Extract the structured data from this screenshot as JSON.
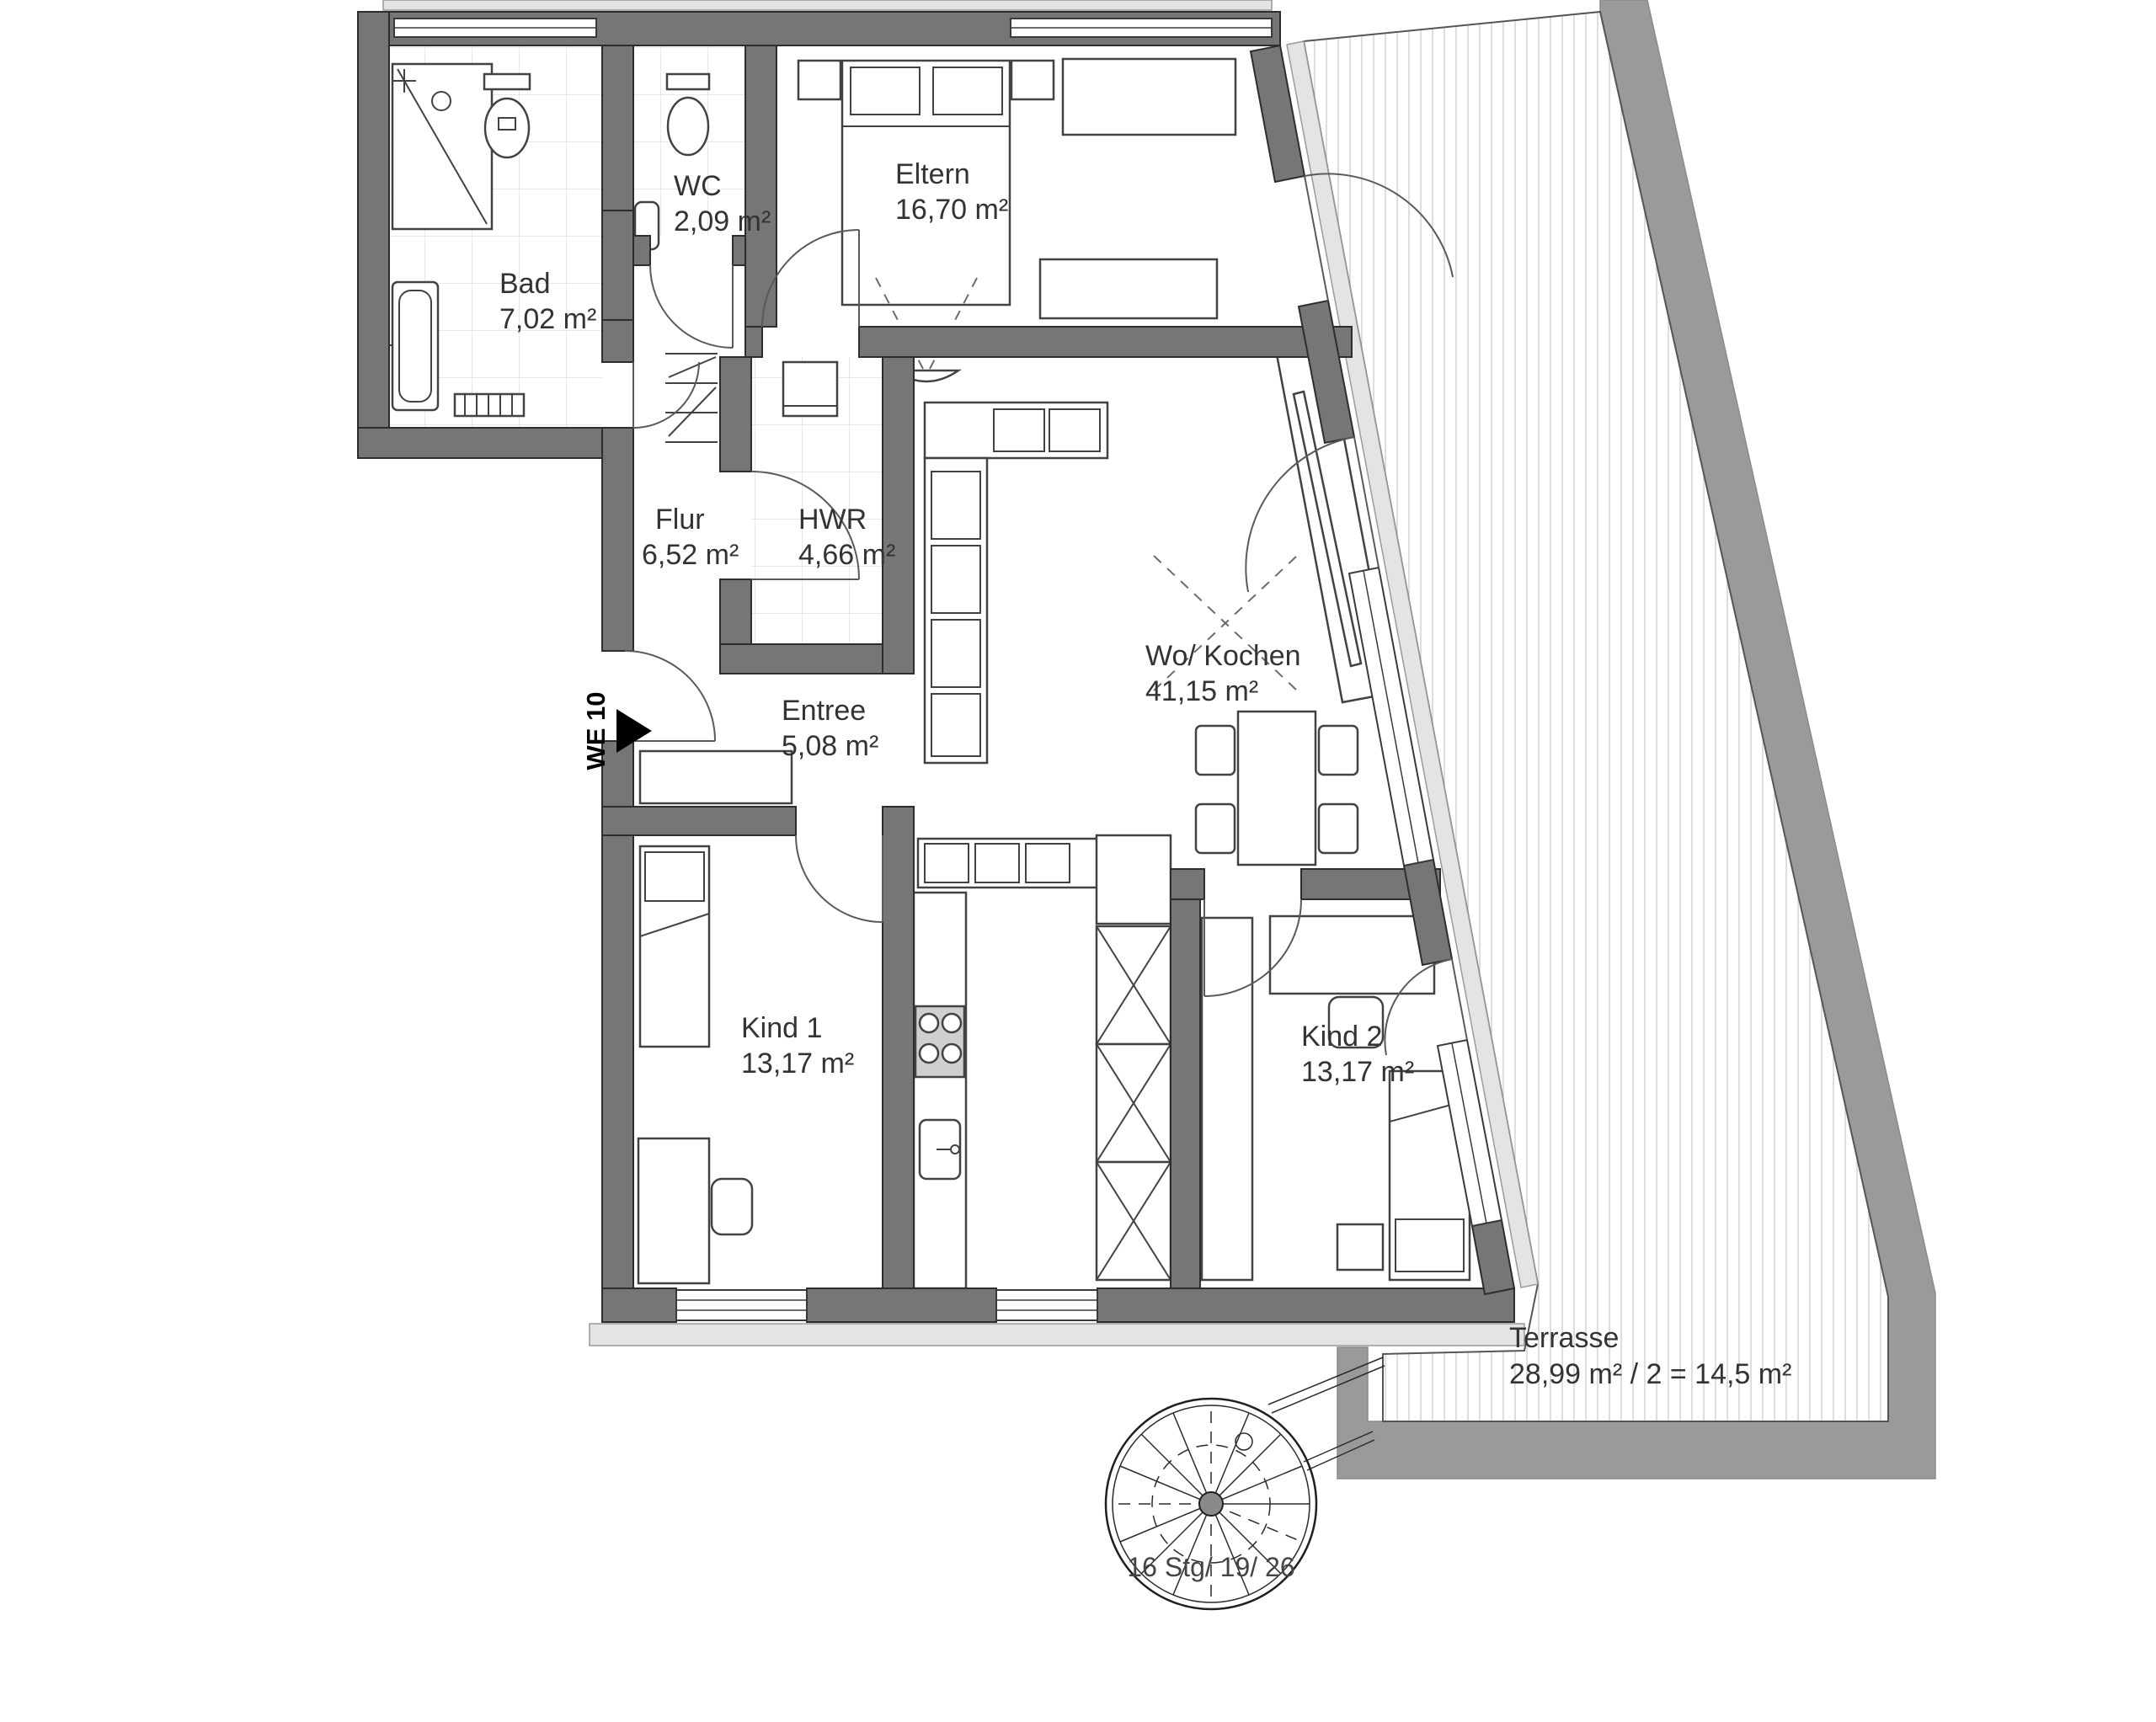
{
  "plan": {
    "unit_label": "WE 10",
    "rooms": [
      {
        "name": "Bad",
        "area": "7,02 m²"
      },
      {
        "name": "WC",
        "area": "2,09 m²"
      },
      {
        "name": "Eltern",
        "area": "16,70 m²"
      },
      {
        "name": "Flur",
        "area": "6,52 m²"
      },
      {
        "name": "HWR",
        "area": "4,66 m²"
      },
      {
        "name": "Wo/ Kochen",
        "area": "41,15 m²"
      },
      {
        "name": "Entree",
        "area": "5,08 m²"
      },
      {
        "name": "Kind 1",
        "area": "13,17 m²"
      },
      {
        "name": "Kind 2",
        "area": "13,17 m²"
      },
      {
        "name": "Terrasse",
        "area": "28,99 m² / 2 = 14,5 m²"
      }
    ],
    "stairs_label": "16 Stg/ 19/ 26",
    "colors": {
      "wall": "#767676",
      "outer_band": "#9a9a9a",
      "sill": "#e4e4e4",
      "tile": "#e0e0e0",
      "deck": "#c9c9c9",
      "label": "#333333"
    }
  }
}
